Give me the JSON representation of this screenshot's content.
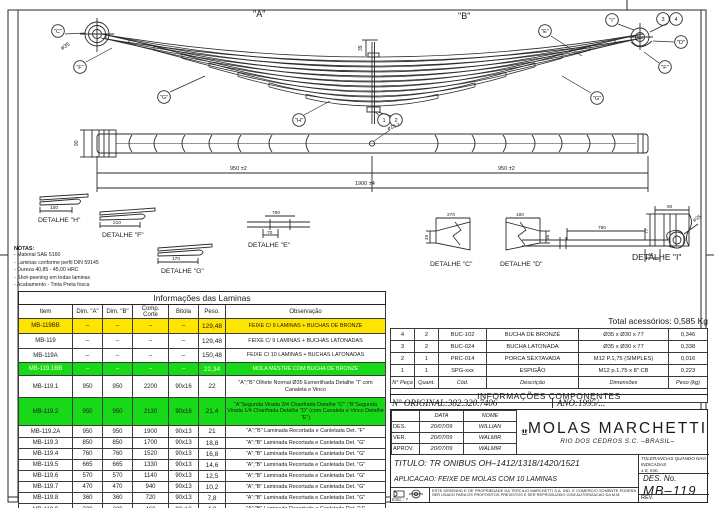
{
  "view": {
    "label_a": "\"A\"",
    "label_b": "\"B\"",
    "balloons": {
      "c": "\"C\"",
      "f_left": "\"F\"",
      "g_left": "\"G\"",
      "h": "\"H\"",
      "e": "\"E\"",
      "i": "\"I\"",
      "d": "\"D\"",
      "f_right": "\"F\"",
      "g_right": "\"G\"",
      "n1": "1",
      "n2": "2",
      "n3": "3",
      "n4": "4"
    },
    "dims": {
      "eye_dia": "ø35",
      "bolt_stick": "39",
      "plan_width": "90",
      "half_left": "950 ±2",
      "half_right": "950 ±2",
      "total": "1900 ±4",
      "hole": "ø13.7"
    }
  },
  "notes": {
    "title": "NOTAS:",
    "items": [
      "- Material SAE 5160",
      "- Laminas conforme perfil DIN 59145",
      "- Dureza 40,85 - 45,00 HRC",
      "- Shot-peening em todas laminas",
      "- Acabamento - Tinta Preta fosca"
    ]
  },
  "details": {
    "h": {
      "label": "DETALHE \"H\"",
      "dim": "100"
    },
    "f": {
      "label": "DETALHE \"F\"",
      "dim": "210"
    },
    "g": {
      "label": "DETALHE \"G\"",
      "dim": "170"
    },
    "e": {
      "label": "DETALHE \"E\"",
      "dim_top": "780",
      "dim_bottom": "70"
    },
    "i": {
      "label": "DETALHE \"I\"",
      "dim_w": "90",
      "dim_h": "77"
    },
    "c": {
      "label": "DETALHE \"C\"",
      "dim_w": "270",
      "dim_h": "45"
    },
    "d": {
      "label": "DETALHE \"D\"",
      "dim_w": "180",
      "dim_h": "35"
    },
    "leaf2": {
      "dim_len": "780",
      "dim_off": "40",
      "dim_eye": "ø35"
    }
  },
  "laminas": {
    "title": "Informações das Laminas",
    "headers": [
      "Item",
      "Dim. \"A\"",
      "Dim. \"B\"",
      "Comp. Corte",
      "Bitola",
      "Peso.",
      "Observação"
    ],
    "rows": [
      {
        "item": "MB-119BB",
        "a": "–",
        "b": "–",
        "corte": "–",
        "bitola": "–",
        "peso": "129,48",
        "obs": "FEIXE C/ 9 LAMINAS + BUCHAS DE BRONZE",
        "hl": "yellow"
      },
      {
        "item": "MB-119",
        "a": "–",
        "b": "–",
        "corte": "–",
        "bitola": "–",
        "peso": "129,48",
        "obs": "FEIXE C/ 9 LAMINAS + BUCHAS LATONADAS"
      },
      {
        "item": "MB-119A",
        "a": "–",
        "b": "–",
        "corte": "–",
        "bitola": "–",
        "peso": "150,48",
        "obs": "FEIXE C/ 10 LAMINAS + BUCHAS LATONADAS"
      },
      {
        "item": "MB-119.1BB",
        "a": "–",
        "b": "–",
        "corte": "–",
        "bitola": "–",
        "peso": "22,34",
        "obs": "MOLA MESTRE COM BUCHA DE BRONZE",
        "hl": "green-w"
      },
      {
        "item": "MB-119.1",
        "a": "950",
        "b": "950",
        "corte": "2200",
        "bitola": "90x16",
        "peso": "22",
        "obs": "\"A\";\"B\" Olhete Normal Ø35 Esmerilhada Detalhe \"I\" com Canaleta e Vinco",
        "wrap": true
      },
      {
        "item": "MB-119.2",
        "a": "950",
        "b": "950",
        "corte": "2130",
        "bitola": "90x16",
        "peso": "21,4",
        "obs": "\"A\"Segunda Virada 3/4 Chanfrada Detalhe \"C\" ;\"B\"Segunda Virada 1/4 Chanfrada Detalhe \"D\" (com Canaleta e Vinco Detalhe \"E\")",
        "hl": "green",
        "wrap": true
      },
      {
        "item": "MB-119.2A",
        "a": "950",
        "b": "950",
        "corte": "1900",
        "bitola": "90x13",
        "peso": "21",
        "obs": "\"A\";\"B\" Laminada Recortada e Canletada Det. \"F\""
      },
      {
        "item": "MB-119.3",
        "a": "850",
        "b": "850",
        "corte": "1700",
        "bitola": "90x13",
        "peso": "18,8",
        "obs": "\"A\";\"B\" Laminada Recortada e Canletada Det. \"G\""
      },
      {
        "item": "MB-119.4",
        "a": "760",
        "b": "760",
        "corte": "1520",
        "bitola": "90x13",
        "peso": "16,8",
        "obs": "\"A\";\"B\" Laminada Recortada e Canletada Det. \"G\""
      },
      {
        "item": "MB-119.5",
        "a": "665",
        "b": "665",
        "corte": "1330",
        "bitola": "90x13",
        "peso": "14,6",
        "obs": "\"A\";\"B\" Laminada Recortada e Canletada Det. \"G\""
      },
      {
        "item": "MB-119.6",
        "a": "570",
        "b": "570",
        "corte": "1140",
        "bitola": "90x13",
        "peso": "12,5",
        "obs": "\"A\";\"B\" Laminada Recortada e Canletada Det. \"G\""
      },
      {
        "item": "MB-119.7",
        "a": "470",
        "b": "470",
        "corte": "940",
        "bitola": "90x13",
        "peso": "10,2",
        "obs": "\"A\";\"B\" Laminada Recortada e Canletada Det. \"G\""
      },
      {
        "item": "MB-119.8",
        "a": "360",
        "b": "360",
        "corte": "720",
        "bitola": "90x13",
        "peso": "7,8",
        "obs": "\"A\";\"B\" Laminada Recortada e Canletada Det. \"G\""
      },
      {
        "item": "MB-119.9",
        "a": "230",
        "b": "230",
        "corte": "460",
        "bitola": "90x13",
        "peso": "4,8",
        "obs": "\"A\";\"B\" Laminada Recortada e Canletada Det. \"H\""
      }
    ]
  },
  "componentes": {
    "total": "Total acessórios: 0,585 Kg",
    "title": "INFORMAÇÕES COMPONENTES",
    "headers": [
      "N° Peça",
      "Quant.",
      "Cód.",
      "Descrição",
      "Dimensões",
      "Peso (kg)"
    ],
    "rows": [
      {
        "n": "4",
        "qt": "2",
        "cod": "BUC-102",
        "desc": "BUCHA DE BRONZE",
        "dim": "Ø35 x Ø30 x 77",
        "peso": "0,346"
      },
      {
        "n": "3",
        "qt": "2",
        "cod": "BUC-024",
        "desc": "BUCHA LATONADA",
        "dim": "Ø35 x Ø30 x 77",
        "peso": "0,338"
      },
      {
        "n": "2",
        "qt": "1",
        "cod": "PRC-014",
        "desc": "PORCA SEXTAVADA",
        "dim": "M12 P.1,75 (SIMPLES)",
        "peso": "0,016"
      },
      {
        "n": "1",
        "qt": "1",
        "cod": "SPG-xxx",
        "desc": "ESPIGÃO",
        "dim": "M12 p.1,75 x 8\" CB",
        "peso": "0,223"
      }
    ]
  },
  "registro": {
    "original": "N° ORIGINAL:382.320.7406",
    "ano": "ANO:1995/..."
  },
  "title_block": {
    "approval": {
      "col_data": "DATA",
      "col_nome": "NOME",
      "rows": [
        {
          "t": "DES.",
          "d": "20/07/09",
          "n": "WILLIAN"
        },
        {
          "t": "VER.",
          "d": "20/07/09",
          "n": "WALMIR"
        },
        {
          "t": "APROV.",
          "d": "20/07/09",
          "n": "WALMIR"
        }
      ]
    },
    "company": {
      "name": "MOLAS MARCHETTI",
      "sub": "RIO DOS CEDROS   S.C.   –BRASIL–"
    },
    "titulo_label": "TITULO:",
    "titulo": "TR ONIBUS OH–1412/1318/1420/1521",
    "aplicacao_label": "APLICACAO:",
    "aplicacao": "FEIXE DE MOLAS COM 10 LAMINAS",
    "tol_line1": "TOLERANCIAS QUANDO NAO INDICADAS",
    "tol_line2": "± 0,   mm.",
    "des_no_label": "DES. No.",
    "des_no": "MB–119",
    "esc": "ESC.:  ?",
    "legal": "ESTE DESENHO E DE PROPRIEDADE DA TERCILIO MARCHETTI S.A. IND. E COMERCIO SOMENTE PODERA SER USADO PARA OS PROPOSITOS PREVISTOS E SER REPRODUZIDO COM AUTORIZACAO DA M.M.",
    "rev": "REV."
  },
  "colors": {
    "highlight_yellow": "#ffe400",
    "highlight_green": "#18d918",
    "line": "#2a2a2a"
  }
}
